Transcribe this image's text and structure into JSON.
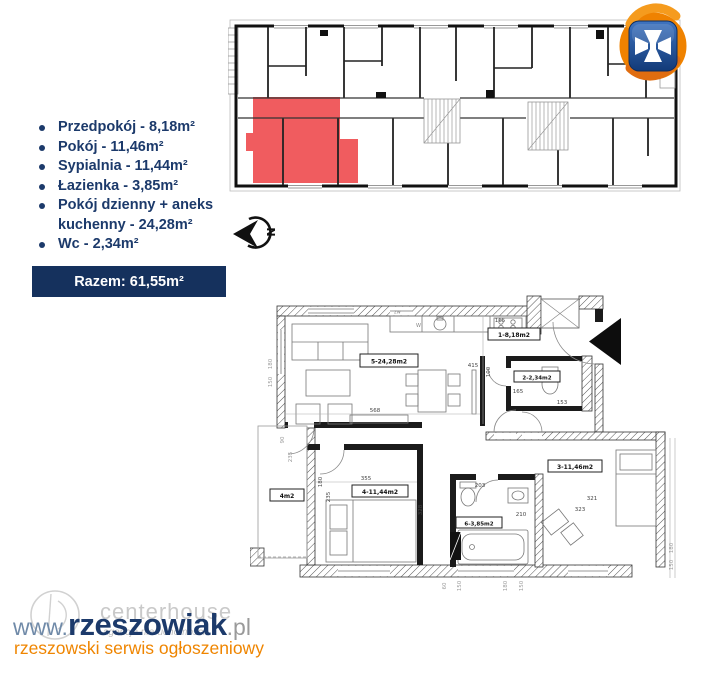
{
  "colors": {
    "navy": "#1c3a6b",
    "razem_bg": "#15315d",
    "red_unit": "#ee4549",
    "orange": "#ef8500",
    "logo_blue": "#1c4587"
  },
  "room_list": {
    "items": [
      "Przedpokój - 8,18m²",
      "Pokój - 11,46m²",
      "Sypialnia - 11,44m²",
      "Łazienka - 3,85m²",
      "Pokój dzienny + aneks kuchenny - 24,28m²",
      "Wc - 2,34m²"
    ]
  },
  "total": {
    "label": "Razem: 61,55m²"
  },
  "north_arrow": {
    "letter": "N"
  },
  "apartment_plan": {
    "labels": {
      "hall": "1-8,18m2",
      "wc": "2-2,34m2",
      "room": "3-11,46m2",
      "bedroom": "4-11,44m2",
      "living": "5-24,28m2",
      "bathroom": "6-3,85m2",
      "balcony": "4m2"
    },
    "fixtures": {
      "zw": "zw",
      "w": "W"
    },
    "dims": {
      "d568": "568",
      "d415": "415",
      "hall165": "165",
      "wc100": "100",
      "wc165": "165",
      "wc153": "153",
      "bed355": "355",
      "bed328": "328",
      "bed180": "180",
      "bed235": "235",
      "bath203": "203",
      "bath210": "210",
      "r321": "321",
      "r323": "323",
      "balc90": "90",
      "balc235": "235",
      "left180": "180",
      "left150": "150",
      "bot60": "60",
      "bot150": "150",
      "bot180": "180",
      "bot150b": "150",
      "right180": "180",
      "right150": "150"
    }
  },
  "watermark": {
    "www": "www.",
    "brand": "rzeszowiak",
    "tld": ".pl",
    "tagline": "rzeszowski serwis ogłoszeniowy",
    "ghost_brand": "centerhouse",
    "ghost_sub": "agencja nieruchomości"
  }
}
